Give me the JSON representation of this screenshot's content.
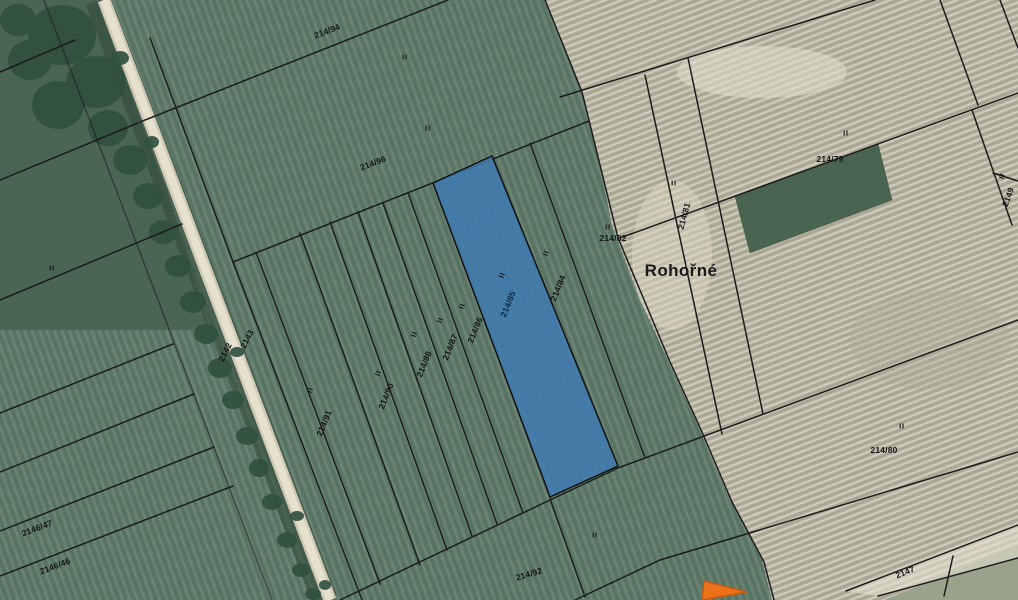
{
  "map": {
    "place_name": "Rohořné",
    "landuse_symbol": "II",
    "highlighted_parcel": {
      "number": "214/85",
      "fill_color": "#3f7ab2"
    },
    "marker": {
      "shape": "triangle",
      "color": "#ed7118"
    },
    "colors": {
      "field_green": "#5d7868",
      "stubble_beige": "#b2af9c",
      "forest_dark": "#31503e",
      "boundary_line": "#1c1c1c",
      "road_light": "#e6e1cf"
    },
    "parcel_numbers": {
      "p214_94": "214/94",
      "p214_96": "214/96",
      "p214_85": "214/85",
      "p214_84": "214/84",
      "p214_86": "214/86",
      "p214_87": "214/87",
      "p214_88": "214/88",
      "p214_90": "214/90",
      "p214_91": "214/91",
      "p214_82": "214/82",
      "p214_81": "214/81",
      "p214_79": "214/79",
      "p214_80": "214/80",
      "p214_92": "214/92",
      "p2147": "2147",
      "p2143": "2143",
      "p2142": "2142",
      "p2146_47": "2146/47",
      "p2146_46": "2146/46",
      "p2149": "2149"
    }
  }
}
